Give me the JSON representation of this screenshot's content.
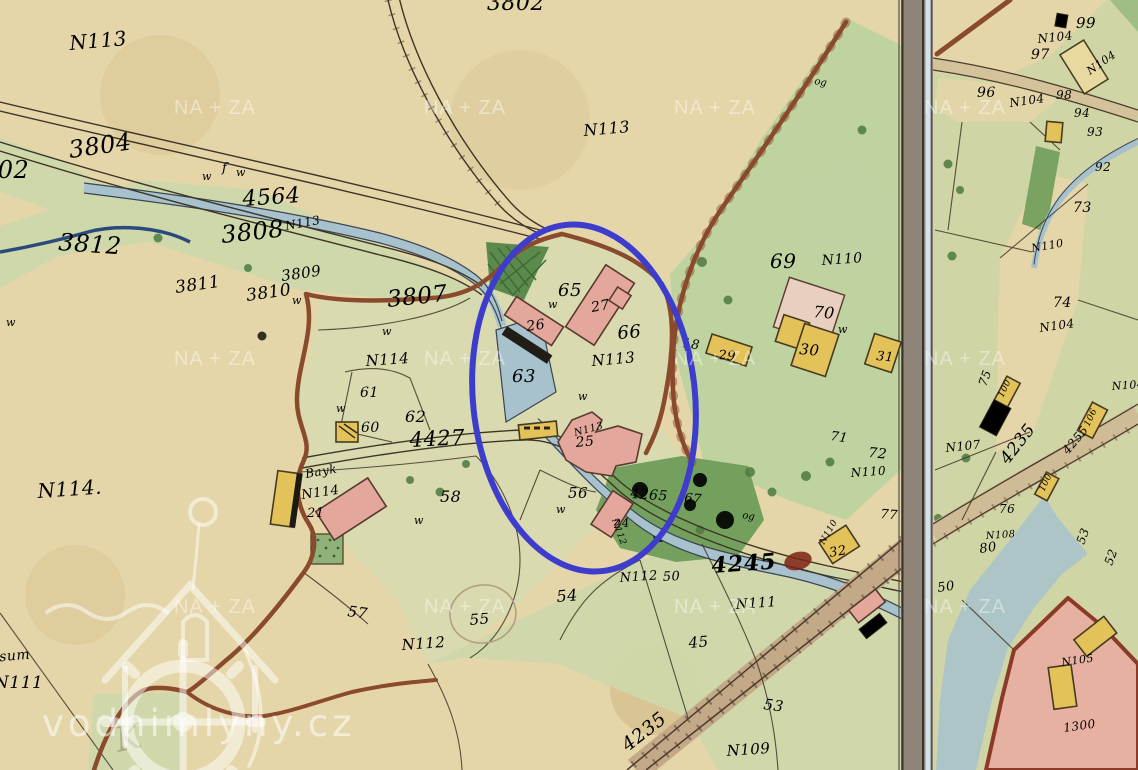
{
  "map_title": "historic cadastral map sheet with mill site highlighted",
  "colors": {
    "paper": "#e5d6a9",
    "meadow": "#ccd8ab",
    "meadow_pale": "#d7dbb0",
    "green_big": "#bcd3a1",
    "forest": "#74a05e",
    "forest_dark": "#4e7a42",
    "water": "#a7c2cc",
    "water_dark": "#3a4452",
    "brook": "#2a4a7c",
    "line": "#3f3527",
    "boundary": "#8a4a2c",
    "pink": "#e3a89b",
    "yellow": "#e3c25a",
    "dark_bldg": "#4a3828",
    "red_label": "#a8492f",
    "red_dark": "#8e3420",
    "black_label": "#2e2619",
    "band_fill": "#8f8478",
    "band_blue": "#cfe4ec",
    "annotation_blue": "#3d3ccd"
  },
  "annotation": {
    "shape": "ellipse",
    "cx": 584,
    "cy": 398,
    "rx": 111,
    "ry": 174,
    "rot": -6,
    "stroke_width": 6
  },
  "watermarks": {
    "site": "vodnimlyny.cz",
    "tile": "NA + ZA",
    "grid_xs": [
      215,
      465,
      715,
      965
    ],
    "grid_ys": [
      114,
      365,
      613
    ]
  },
  "labels": {
    "red": [
      {
        "t": "3802",
        "x": 487,
        "y": 10,
        "s": 22,
        "r": 0
      },
      {
        "t": "302",
        "x": -18,
        "y": 178,
        "s": 24,
        "r": 0
      },
      {
        "t": "3804",
        "x": 70,
        "y": 158,
        "s": 24,
        "r": -8
      },
      {
        "t": "4564",
        "x": 243,
        "y": 206,
        "s": 22,
        "r": -4
      },
      {
        "t": "3812",
        "x": 58,
        "y": 250,
        "s": 24,
        "r": 4
      },
      {
        "t": "3808",
        "x": 222,
        "y": 243,
        "s": 24,
        "r": -6
      },
      {
        "t": "3811",
        "x": 176,
        "y": 293,
        "s": 17,
        "r": -8
      },
      {
        "t": "3809",
        "x": 282,
        "y": 281,
        "s": 15,
        "r": -8
      },
      {
        "t": "3810",
        "x": 247,
        "y": 301,
        "s": 17,
        "r": -8
      },
      {
        "t": "3807",
        "x": 388,
        "y": 307,
        "s": 23,
        "r": -6
      },
      {
        "t": "65",
        "x": 558,
        "y": 296,
        "s": 18,
        "r": 0
      },
      {
        "t": "66",
        "x": 618,
        "y": 339,
        "s": 18,
        "r": -5
      },
      {
        "t": "63",
        "x": 512,
        "y": 382,
        "s": 18,
        "r": 0
      },
      {
        "t": "N113",
        "x": 575,
        "y": 436,
        "s": 10,
        "r": -15
      },
      {
        "t": "4427",
        "x": 410,
        "y": 447,
        "s": 21,
        "r": -3
      },
      {
        "t": "61",
        "x": 360,
        "y": 397,
        "s": 14,
        "r": 0
      },
      {
        "t": "60",
        "x": 361,
        "y": 432,
        "s": 14,
        "r": 0
      },
      {
        "t": "62",
        "x": 405,
        "y": 422,
        "s": 16,
        "r": 0
      },
      {
        "t": "58",
        "x": 440,
        "y": 502,
        "s": 16,
        "r": 0
      },
      {
        "t": "57",
        "x": 347,
        "y": 616,
        "s": 15,
        "r": 8
      },
      {
        "t": "56",
        "x": 568,
        "y": 498,
        "s": 15,
        "r": 0
      },
      {
        "t": "4265",
        "x": 630,
        "y": 498,
        "s": 14,
        "r": 4
      },
      {
        "t": "67",
        "x": 684,
        "y": 502,
        "s": 13,
        "r": 5
      },
      {
        "t": "N112",
        "x": 612,
        "y": 520,
        "s": 9,
        "r": 70
      },
      {
        "t": "18",
        "x": 682,
        "y": 347,
        "s": 13,
        "r": 8
      },
      {
        "t": "69",
        "x": 770,
        "y": 268,
        "s": 20,
        "r": 0
      },
      {
        "t": "70",
        "x": 813,
        "y": 317,
        "s": 16,
        "r": 5
      },
      {
        "t": "71",
        "x": 830,
        "y": 440,
        "s": 13,
        "r": 8
      },
      {
        "t": "72",
        "x": 868,
        "y": 457,
        "s": 14,
        "r": 5
      },
      {
        "t": "77",
        "x": 880,
        "y": 518,
        "s": 13,
        "r": 5
      },
      {
        "t": "N110",
        "x": 824,
        "y": 545,
        "s": 9,
        "r": -60
      },
      {
        "t": "54",
        "x": 557,
        "y": 602,
        "s": 16,
        "r": -5
      },
      {
        "t": "55",
        "x": 470,
        "y": 625,
        "s": 15,
        "r": -5
      },
      {
        "t": "50",
        "x": 663,
        "y": 581,
        "s": 13,
        "r": -3
      },
      {
        "t": "45",
        "x": 689,
        "y": 648,
        "s": 15,
        "r": -5
      },
      {
        "t": "53",
        "x": 763,
        "y": 709,
        "s": 15,
        "r": 8
      },
      {
        "t": "4235",
        "x": 628,
        "y": 752,
        "s": 19,
        "r": -38
      },
      {
        "t": "4235",
        "x": 1008,
        "y": 465,
        "s": 17,
        "r": -52
      },
      {
        "t": "4255",
        "x": 1068,
        "y": 455,
        "s": 12,
        "r": -50
      },
      {
        "t": "N114",
        "x": 302,
        "y": 499,
        "s": 13,
        "r": -8
      },
      {
        "t": "Bayk",
        "x": 306,
        "y": 478,
        "s": 12,
        "r": -10
      },
      {
        "t": "96",
        "x": 977,
        "y": 97,
        "s": 14,
        "r": 0
      },
      {
        "t": "97",
        "x": 1031,
        "y": 59,
        "s": 14,
        "r": 0
      },
      {
        "t": "98",
        "x": 1056,
        "y": 99,
        "s": 12,
        "r": 0
      },
      {
        "t": "99",
        "x": 1076,
        "y": 28,
        "s": 15,
        "r": 0
      },
      {
        "t": "94",
        "x": 1074,
        "y": 117,
        "s": 12,
        "r": 0
      },
      {
        "t": "93",
        "x": 1087,
        "y": 136,
        "s": 12,
        "r": 0
      },
      {
        "t": "92",
        "x": 1095,
        "y": 171,
        "s": 12,
        "r": 0
      },
      {
        "t": "73",
        "x": 1073,
        "y": 212,
        "s": 14,
        "r": 0
      },
      {
        "t": "74",
        "x": 1053,
        "y": 307,
        "s": 14,
        "r": 0
      },
      {
        "t": "75",
        "x": 986,
        "y": 387,
        "s": 12,
        "r": -70
      },
      {
        "t": "100",
        "x": 1003,
        "y": 398,
        "s": 9,
        "r": -65
      },
      {
        "t": "106",
        "x": 1089,
        "y": 427,
        "s": 9,
        "r": -65
      },
      {
        "t": "100",
        "x": 1044,
        "y": 492,
        "s": 9,
        "r": -65
      },
      {
        "t": "76",
        "x": 999,
        "y": 513,
        "s": 12,
        "r": 0
      },
      {
        "t": "80",
        "x": 980,
        "y": 553,
        "s": 13,
        "r": -8
      },
      {
        "t": "50",
        "x": 938,
        "y": 592,
        "s": 13,
        "r": -8
      },
      {
        "t": "53",
        "x": 1084,
        "y": 545,
        "s": 12,
        "r": -70
      },
      {
        "t": "52",
        "x": 1112,
        "y": 566,
        "s": 12,
        "r": -70
      },
      {
        "t": "1300",
        "x": 1064,
        "y": 732,
        "s": 12,
        "r": -8
      }
    ],
    "red_bold": [
      {
        "t": "4245",
        "x": 712,
        "y": 573,
        "s": 22,
        "r": -4
      }
    ],
    "black": [
      {
        "t": "N113",
        "x": 70,
        "y": 50,
        "s": 20,
        "r": -5
      },
      {
        "t": "N113",
        "x": 584,
        "y": 136,
        "s": 16,
        "r": -5
      },
      {
        "t": "N113",
        "x": 286,
        "y": 230,
        "s": 12,
        "r": -10
      },
      {
        "t": "N114",
        "x": 366,
        "y": 366,
        "s": 15,
        "r": -4
      },
      {
        "t": "N113",
        "x": 592,
        "y": 366,
        "s": 15,
        "r": -5
      },
      {
        "t": "N114.",
        "x": 38,
        "y": 498,
        "s": 20,
        "r": -4
      },
      {
        "t": "27",
        "x": 592,
        "y": 312,
        "s": 14,
        "r": -10
      },
      {
        "t": "26",
        "x": 527,
        "y": 331,
        "s": 14,
        "r": -8
      },
      {
        "t": "25",
        "x": 576,
        "y": 447,
        "s": 14,
        "r": -5
      },
      {
        "t": "24",
        "x": 614,
        "y": 528,
        "s": 12,
        "r": -5
      },
      {
        "t": "21",
        "x": 307,
        "y": 517,
        "s": 13,
        "r": 0
      },
      {
        "t": "29",
        "x": 718,
        "y": 359,
        "s": 13,
        "r": 5
      },
      {
        "t": "30",
        "x": 799,
        "y": 354,
        "s": 15,
        "r": 5
      },
      {
        "t": "31",
        "x": 876,
        "y": 360,
        "s": 13,
        "r": 5
      },
      {
        "t": "32",
        "x": 830,
        "y": 557,
        "s": 13,
        "r": -10
      },
      {
        "t": "N112",
        "x": 402,
        "y": 650,
        "s": 15,
        "r": -4
      },
      {
        "t": "N112",
        "x": 620,
        "y": 582,
        "s": 13,
        "r": -4
      },
      {
        "t": "N111",
        "x": 736,
        "y": 609,
        "s": 14,
        "r": -4
      },
      {
        "t": "N111",
        "x": -6,
        "y": 688,
        "s": 17,
        "r": 0
      },
      {
        "t": "N109",
        "x": 727,
        "y": 756,
        "s": 15,
        "r": -4
      },
      {
        "t": "N110",
        "x": 822,
        "y": 265,
        "s": 14,
        "r": -4
      },
      {
        "t": "N110",
        "x": 851,
        "y": 477,
        "s": 12,
        "r": -4
      },
      {
        "t": "N110",
        "x": 1032,
        "y": 252,
        "s": 11,
        "r": -10
      },
      {
        "t": "N104",
        "x": 1038,
        "y": 43,
        "s": 12,
        "r": -6
      },
      {
        "t": "N104",
        "x": 1010,
        "y": 107,
        "s": 12,
        "r": -8
      },
      {
        "t": "N104",
        "x": 1090,
        "y": 75,
        "s": 11,
        "r": -35
      },
      {
        "t": "N104",
        "x": 1040,
        "y": 332,
        "s": 12,
        "r": -8
      },
      {
        "t": "N104",
        "x": 1112,
        "y": 390,
        "s": 11,
        "r": -4
      },
      {
        "t": "N107",
        "x": 946,
        "y": 452,
        "s": 12,
        "r": -6
      },
      {
        "t": "N108",
        "x": 986,
        "y": 539,
        "s": 10,
        "r": -4
      },
      {
        "t": "N105",
        "x": 1062,
        "y": 666,
        "s": 11,
        "r": -8
      },
      {
        "t": "ssum",
        "x": -8,
        "y": 662,
        "s": 14,
        "r": -5
      }
    ],
    "symbols": [
      {
        "t": "w",
        "x": 202,
        "y": 180,
        "s": 11,
        "r": 0
      },
      {
        "t": "w",
        "x": 236,
        "y": 176,
        "s": 11,
        "r": 0
      },
      {
        "t": "w",
        "x": 292,
        "y": 304,
        "s": 11,
        "r": 0
      },
      {
        "t": "w",
        "x": 382,
        "y": 335,
        "s": 11,
        "r": 0
      },
      {
        "t": "w",
        "x": 336,
        "y": 412,
        "s": 11,
        "r": 0
      },
      {
        "t": "w",
        "x": 548,
        "y": 308,
        "s": 11,
        "r": 0
      },
      {
        "t": "w",
        "x": 578,
        "y": 400,
        "s": 11,
        "r": 0
      },
      {
        "t": "w",
        "x": 556,
        "y": 513,
        "s": 11,
        "r": 0
      },
      {
        "t": "w",
        "x": 838,
        "y": 333,
        "s": 11,
        "r": 0
      },
      {
        "t": "w",
        "x": 6,
        "y": 326,
        "s": 11,
        "r": 0
      },
      {
        "t": "w",
        "x": 414,
        "y": 524,
        "s": 11,
        "r": 0
      },
      {
        "t": "og",
        "x": 814,
        "y": 84,
        "s": 10,
        "r": 10
      },
      {
        "t": "og",
        "x": 742,
        "y": 518,
        "s": 10,
        "r": 10
      },
      {
        "t": "f",
        "x": 222,
        "y": 172,
        "s": 13,
        "r": 0
      }
    ],
    "pencil": [
      {
        "t": "K",
        "x": 118,
        "y": 752,
        "s": 34,
        "r": -12
      }
    ]
  }
}
